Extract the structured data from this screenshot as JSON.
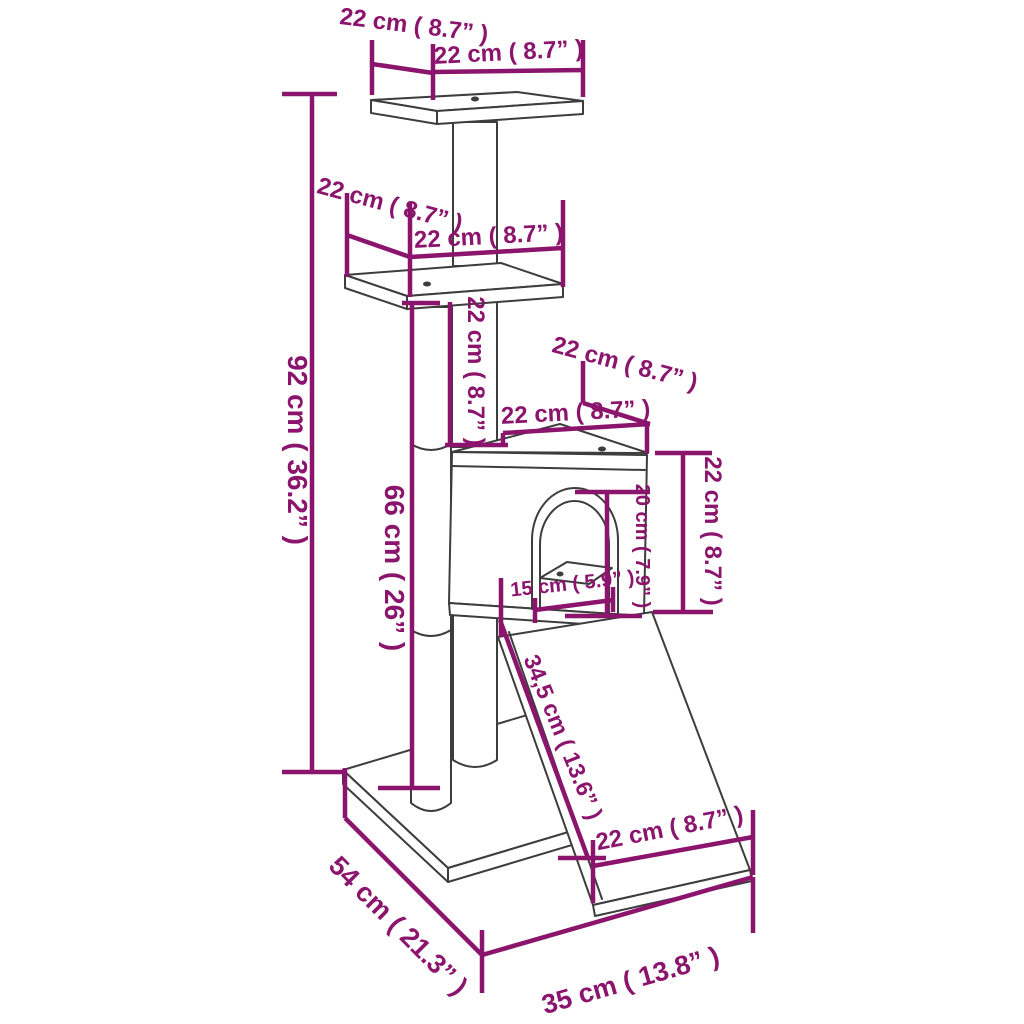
{
  "page": {
    "background": "#ffffff"
  },
  "diagram": {
    "kind": "product dimension line drawing",
    "subject": "cat tree with scratching posts, platforms, house and ramp",
    "outline_color": "#3d3d3d",
    "dimension_color": "#8B146C",
    "units": [
      "cm",
      "in"
    ],
    "labels": {
      "top_platform_depth": {
        "text": "22 cm ( 8.7” )",
        "cm": 22,
        "in": 8.7
      },
      "top_platform_width": {
        "text": "22 cm ( 8.7” )",
        "cm": 22,
        "in": 8.7
      },
      "mid_platform_depth": {
        "text": "22 cm ( 8.7” )",
        "cm": 22,
        "in": 8.7
      },
      "mid_platform_width": {
        "text": "22 cm ( 8.7” )",
        "cm": 22,
        "in": 8.7
      },
      "overall_height": {
        "text": "92 cm ( 36.2” )",
        "cm": 92,
        "in": 36.2
      },
      "main_post_height": {
        "text": "66 cm ( 26” )",
        "cm": 66,
        "in": 26
      },
      "upper_post_height": {
        "text": "22 cm ( 8.7” )",
        "cm": 22,
        "in": 8.7
      },
      "house_roof_depth": {
        "text": "22 cm ( 8.7” )",
        "cm": 22,
        "in": 8.7
      },
      "house_roof_width": {
        "text": "22 cm ( 8.7” )",
        "cm": 22,
        "in": 8.7
      },
      "house_height": {
        "text": "22 cm ( 8.7” )",
        "cm": 22,
        "in": 8.7
      },
      "door_height": {
        "text": "20 cm ( 7.9” )",
        "cm": 20,
        "in": 7.9
      },
      "door_width": {
        "text": "15 cm ( 5.9” )",
        "cm": 15,
        "in": 5.9
      },
      "ramp_length": {
        "text": "34,5 cm ( 13.6” )",
        "cm": 34.5,
        "in": 13.6
      },
      "ramp_width": {
        "text": "22 cm ( 8.7” )",
        "cm": 22,
        "in": 8.7
      },
      "base_depth": {
        "text": "54 cm ( 21.3” )",
        "cm": 54,
        "in": 21.3
      },
      "base_width": {
        "text": "35 cm ( 13.8” )",
        "cm": 35,
        "in": 13.8
      }
    }
  }
}
